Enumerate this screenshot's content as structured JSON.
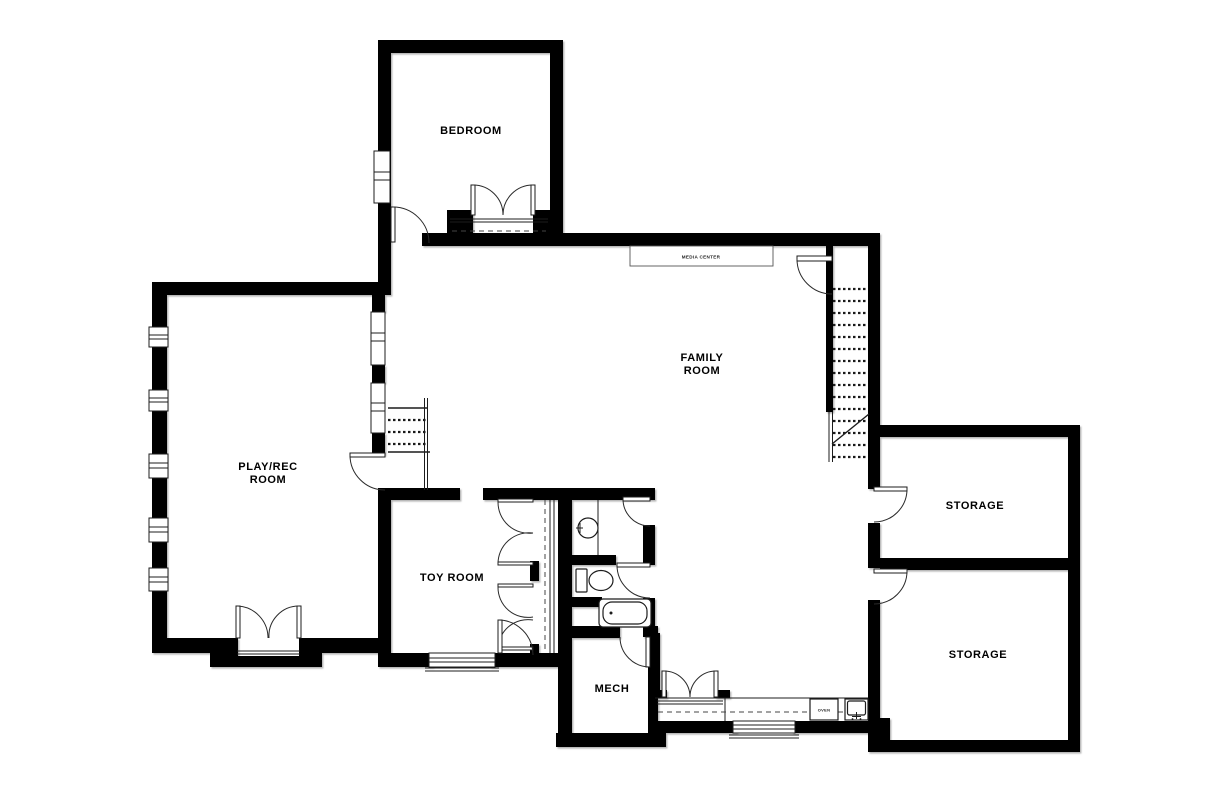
{
  "plan": {
    "rooms": {
      "bedroom": {
        "label": "BEDROOM"
      },
      "family_room": {
        "line1": "FAMILY",
        "line2": "ROOM"
      },
      "play_rec_room": {
        "line1": "PLAY/REC",
        "line2": "ROOM"
      },
      "toy_room": {
        "label": "TOY ROOM"
      },
      "mech_room": {
        "label": "MECH"
      },
      "storage_upper": {
        "label": "STORAGE"
      },
      "storage_lower": {
        "label": "STORAGE"
      }
    },
    "features": {
      "media_center": {
        "label": "MEDIA CENTER"
      },
      "oven": {
        "label": "OVEN"
      }
    },
    "colors": {
      "wall": "#000000",
      "background": "#ffffff",
      "line": "#1c1c1c",
      "shadow": "#a8a8a8"
    }
  }
}
